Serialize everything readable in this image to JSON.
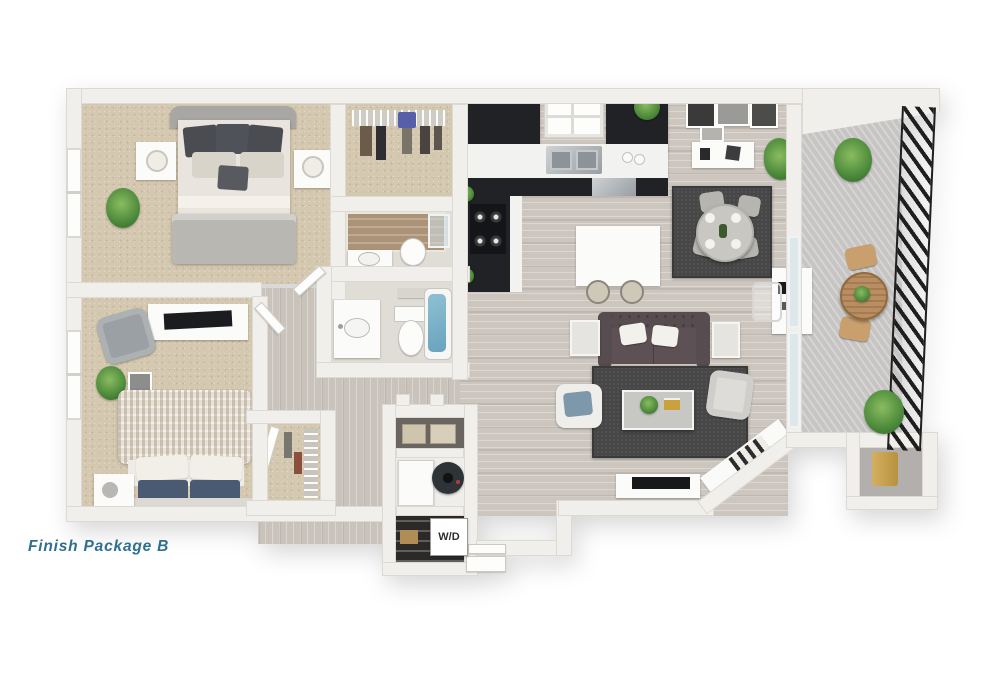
{
  "image": {
    "type": "3d-floorplan-render",
    "view": "top-down dollhouse",
    "background": "#ffffff"
  },
  "caption": {
    "text": "Finish Package B",
    "color": "#2f6f8f"
  },
  "labels": {
    "washer_dryer": "W/D"
  },
  "palette": {
    "wall": "#f0efeb",
    "wood_floor": "#ccc6bf",
    "carpet": "#d5c8b0",
    "cabinets": "#212226",
    "rug": "#474747",
    "sofa": "#574c50",
    "tub_water": "#7db4c9",
    "balcony_concrete": "#c6c5c3",
    "railing": "#1f1f1f",
    "plants": "#4c8a3b",
    "water_heater": "#c8a24b"
  },
  "rooms": [
    {
      "name": "master bedroom",
      "furnishings": [
        "bed",
        "two nightstands with lamps",
        "potted plant",
        "window"
      ]
    },
    {
      "name": "walk-in closet",
      "furnishings": [
        "wire shelf",
        "hanging clothes"
      ]
    },
    {
      "name": "master bathroom",
      "furnishings": [
        "walk-in shower",
        "toilet",
        "vanity sink"
      ]
    },
    {
      "name": "second bathroom",
      "furnishings": [
        "vanity sink",
        "toilet",
        "bathtub"
      ]
    },
    {
      "name": "second bedroom",
      "furnishings": [
        "bed with knit blanket",
        "tv console",
        "armchair",
        "plant",
        "window"
      ]
    },
    {
      "name": "second closet",
      "furnishings": [
        "wire shelf",
        "hanging clothes"
      ]
    },
    {
      "name": "laundry closet",
      "furnishings": [
        "washer-dryer",
        "storage baskets",
        "pantry shelves"
      ]
    },
    {
      "name": "kitchen",
      "furnishings": [
        "black cabinets",
        "double sink",
        "window",
        "stove",
        "dishwasher",
        "island with stools"
      ]
    },
    {
      "name": "dining area",
      "furnishings": [
        "round table with four chairs",
        "rug",
        "sideboard",
        "wall art",
        "plant"
      ]
    },
    {
      "name": "living area",
      "furnishings": [
        "tufted sofa",
        "rug",
        "coffee table",
        "two armchairs",
        "side tables",
        "tv console",
        "desk with chair"
      ]
    },
    {
      "name": "entry",
      "furnishings": [
        "diagonal wall",
        "bench",
        "door step"
      ]
    },
    {
      "name": "storage closet",
      "furnishings": [
        "water heater"
      ]
    },
    {
      "name": "balcony",
      "furnishings": [
        "bistro table",
        "two chairs",
        "railing",
        "potted plants"
      ]
    }
  ]
}
